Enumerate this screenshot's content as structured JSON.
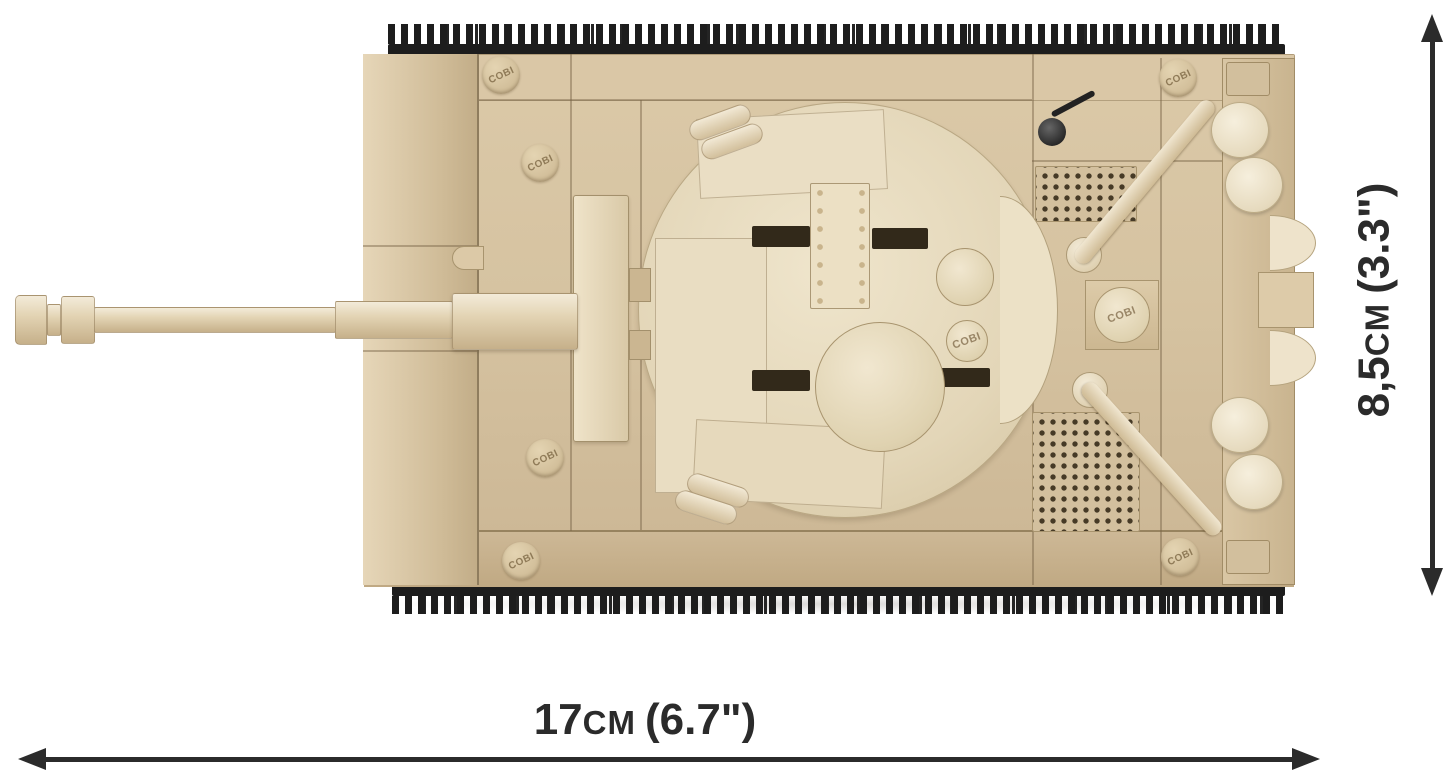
{
  "page": {
    "background": "#ffffff"
  },
  "diagram": {
    "subject": "COBI building-block tank model, top view with size arrows",
    "brand_stud_logo": "COBI",
    "width_dimension": {
      "value": "17",
      "unit": "CM",
      "imperial": "(6.7\")"
    },
    "height_dimension": {
      "value": "8,5",
      "unit": "CM",
      "imperial": "(3.3\")"
    },
    "colors": {
      "hull_tan": "#d5c2a0",
      "turret_cream": "#eadfc6",
      "track_black": "#1d1d1d",
      "wheel_cream": "#f0e7d2",
      "dimension_ink": "#2b2b2b"
    }
  }
}
